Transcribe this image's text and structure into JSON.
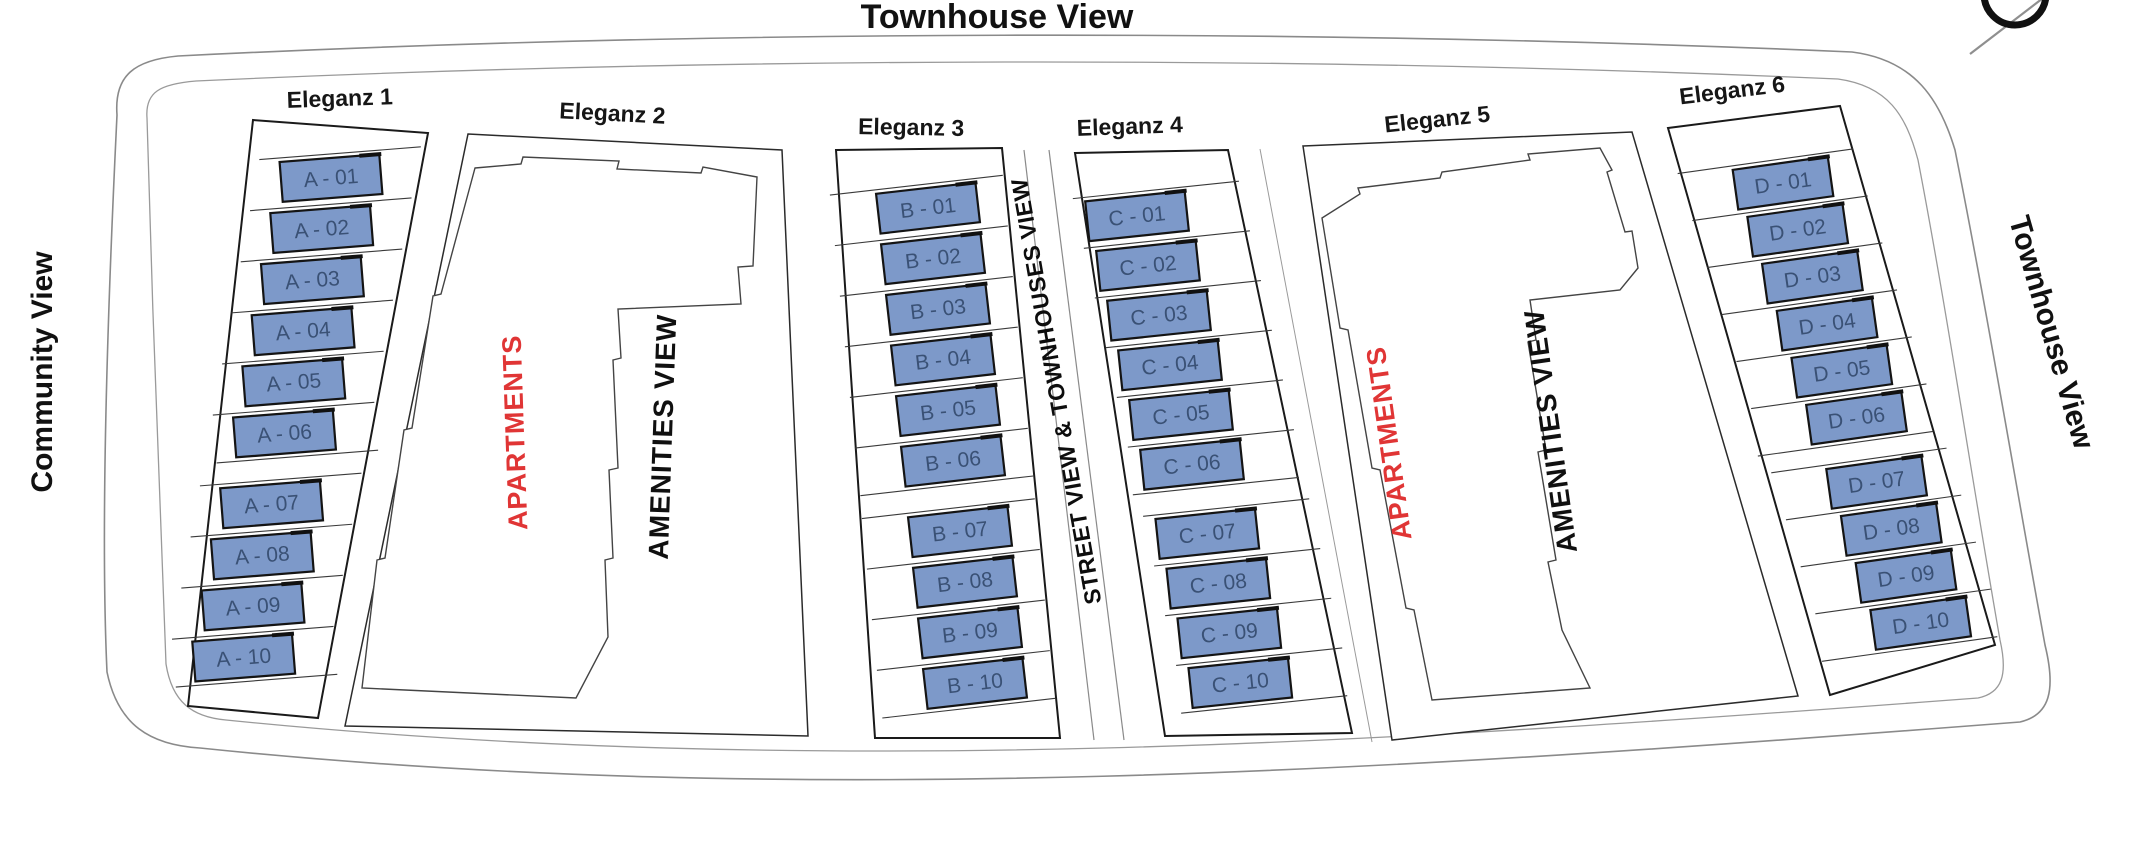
{
  "title": "Townhouse View",
  "side_labels": {
    "left": "Community View",
    "right": "Townhouse View"
  },
  "street_label": "STREET VIEW & TOWNHOUSES VIEW",
  "compass": {
    "icon": "compass-north-icon"
  },
  "colors": {
    "unit_fill": "#7D99C9",
    "unit_stroke": "#141414",
    "unit_text": "#3A5175",
    "apartments_red": "#E03535",
    "outline_dark": "#1a1a1a",
    "road_gray": "#8a8a8a"
  },
  "sections": [
    {
      "name": "Eleganz 1",
      "type": "townhouses",
      "units": [
        "A - 01",
        "A - 02",
        "A - 03",
        "A - 04",
        "A - 05",
        "A - 06",
        "A - 07",
        "A - 08",
        "A - 09",
        "A - 10"
      ]
    },
    {
      "name": "Eleganz 2",
      "type": "apartments",
      "labels": {
        "building": "APARTMENTS",
        "view": "AMENITIES VIEW"
      }
    },
    {
      "name": "Eleganz 3",
      "type": "townhouses",
      "units": [
        "B - 01",
        "B - 02",
        "B - 03",
        "B - 04",
        "B - 05",
        "B - 06",
        "B - 07",
        "B - 08",
        "B - 09",
        "B - 10"
      ]
    },
    {
      "name": "Eleganz 4",
      "type": "townhouses",
      "units": [
        "C - 01",
        "C - 02",
        "C - 03",
        "C - 04",
        "C - 05",
        "C - 06",
        "C - 07",
        "C - 08",
        "C - 09",
        "C - 10"
      ]
    },
    {
      "name": "Eleganz 5",
      "type": "apartments",
      "labels": {
        "building": "APARTMENTS",
        "view": "AMENITIES VIEW"
      }
    },
    {
      "name": "Eleganz 6",
      "type": "townhouses",
      "units": [
        "D - 01",
        "D - 02",
        "D - 03",
        "D - 04",
        "D - 05",
        "D - 06",
        "D - 07",
        "D - 08",
        "D - 09",
        "D - 10"
      ]
    }
  ]
}
